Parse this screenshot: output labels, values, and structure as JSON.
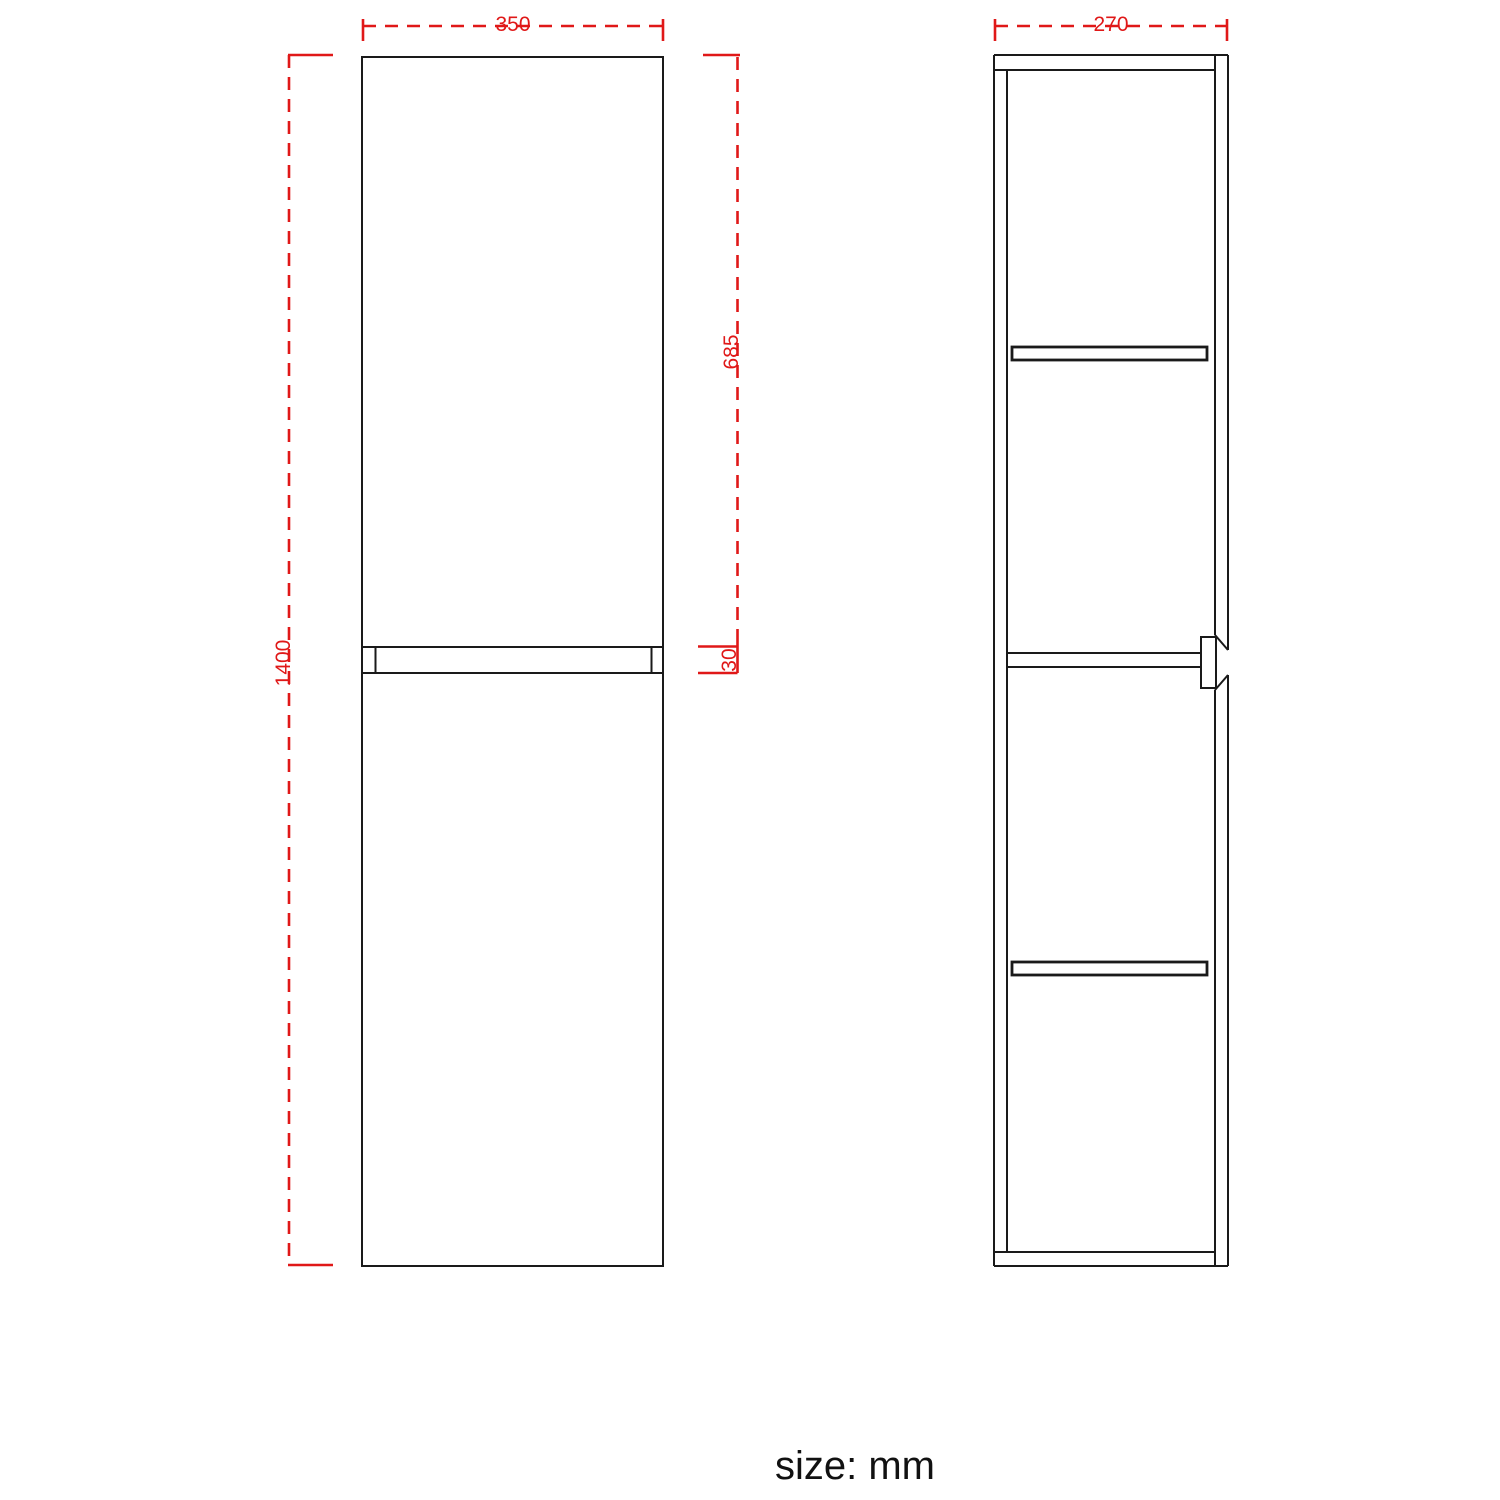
{
  "drawing": {
    "unit_note": "size: mm",
    "colors": {
      "dimension": "#e01818",
      "outline": "#1a1a1a",
      "background": "#ffffff"
    },
    "views": {
      "front": {
        "name": "front view",
        "dimensions": {
          "width": "350",
          "height": "1400",
          "upper_door_height": "685",
          "divider_gap": "30"
        }
      },
      "side": {
        "name": "side view",
        "dimensions": {
          "depth": "270"
        }
      }
    }
  }
}
